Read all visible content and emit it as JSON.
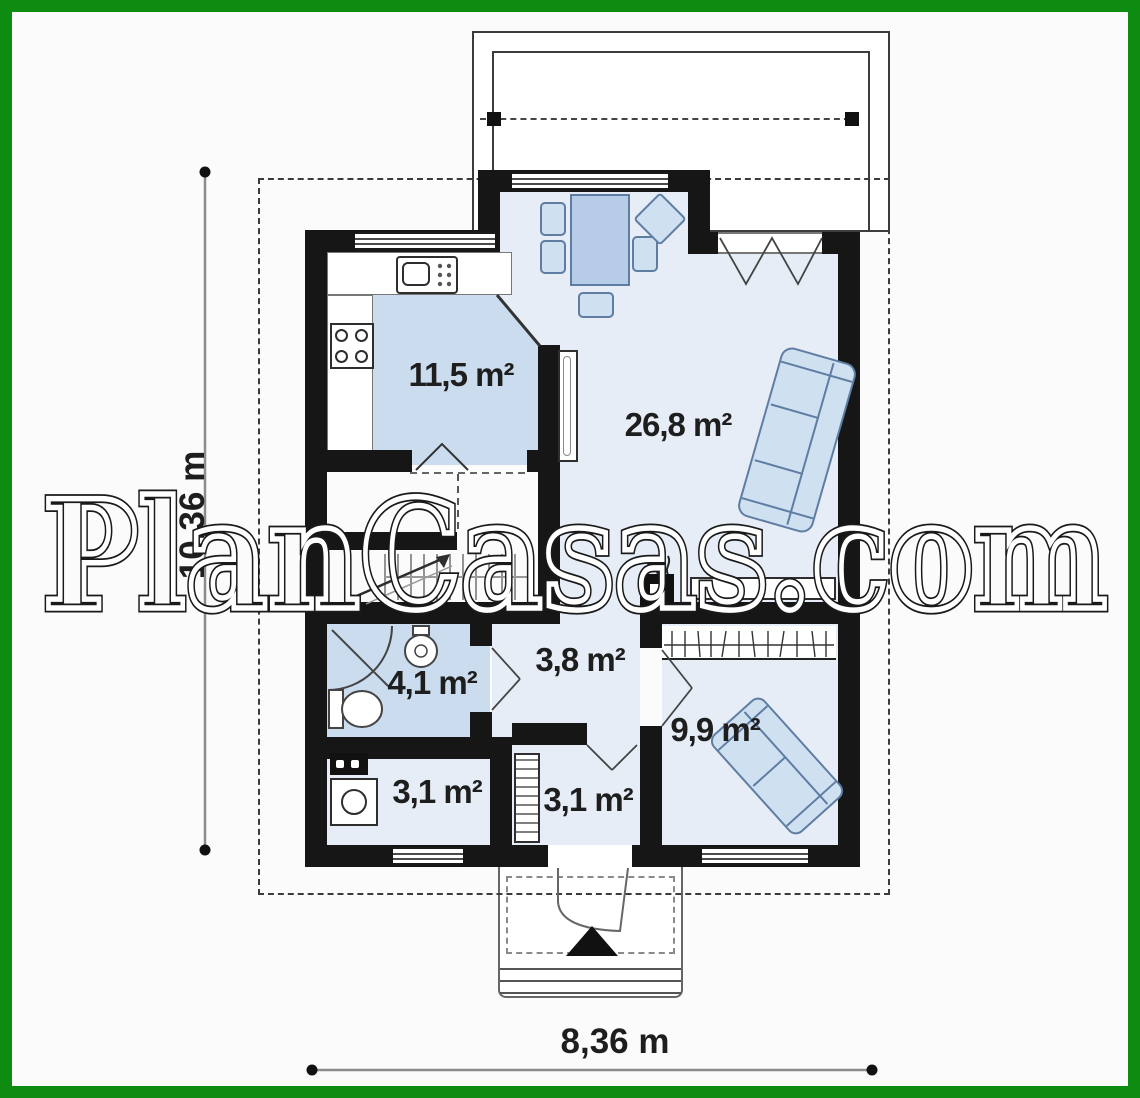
{
  "watermark": "PlanCasas.com",
  "rooms": {
    "kitchen": "11,5 m²",
    "living": "26,8 m²",
    "hall": "3,8 m²",
    "bathroom": "4,1 m²",
    "bedroom": "9,9 m²",
    "utility": "3,1 m²",
    "vestibule": "3,1 m²"
  },
  "dimensions": {
    "width": "8,36 m",
    "height": "10,36 m"
  },
  "colors": {
    "frame_green": "#0e8c12",
    "wall_black": "#161616",
    "floor_light_blue": "#e6edf7",
    "floor_mid_blue": "#cadcee",
    "furniture_fill": "#cfe0f1",
    "furniture_stroke": "#5f7da3"
  },
  "icons": {
    "stairs_arrow": "stairs-up-arrow-icon",
    "entrance_arrow": "entrance-arrow-icon",
    "fireplace": "fireplace-icon",
    "shower": "shower-icon",
    "toilet": "toilet-icon",
    "washbasin": "washbasin-icon",
    "washing_machine": "washing-machine-icon",
    "stove": "stove-icon",
    "kitchen_sink": "kitchen-sink-icon",
    "wardrobe": "wardrobe-hangers-icon"
  }
}
